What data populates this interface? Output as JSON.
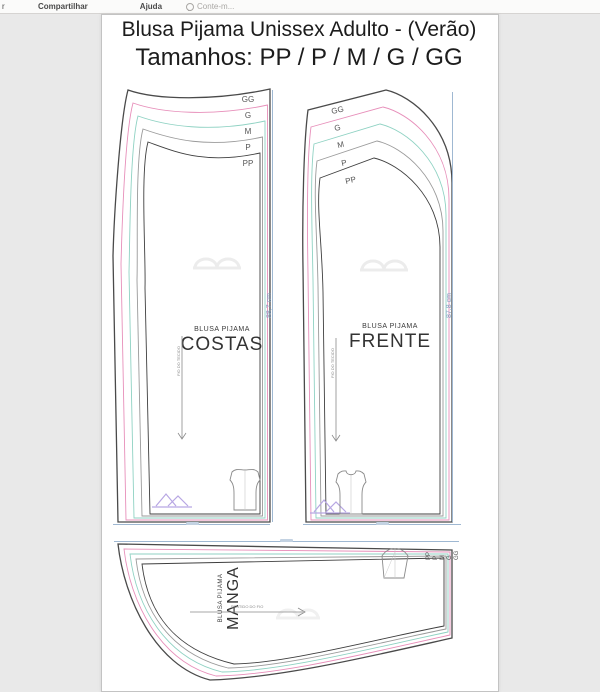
{
  "toolbar": {
    "fragment": "r",
    "share_label": "Compartilhar",
    "help_label": "Ajuda",
    "tellme_label": "Conte-m...",
    "tellme_icon": "lightbulb-icon"
  },
  "doc": {
    "title": "Blusa Pijama Unissex Adulto - (Verão)",
    "subtitle": "Tamanhos: PP / P / M / G / GG",
    "costas": {
      "brand": "BLUSA PIJAMA",
      "name": "COSTAS",
      "grain": "FIO DO TECIDO",
      "dim": "88,7 cm",
      "sizes": [
        "GG",
        "G",
        "M",
        "P",
        "PP"
      ]
    },
    "frente": {
      "brand": "BLUSA PIJAMA",
      "name": "FRENTE",
      "grain": "FIO DO TECIDO",
      "dim": "87,8 cm",
      "sizes": [
        "GG",
        "G",
        "M",
        "P",
        "PP"
      ]
    },
    "manga": {
      "brand": "BLUSA PIJAMA",
      "name": "MANGA",
      "grain": "SENTIDO DO FIO",
      "sizes": [
        "PP",
        "P",
        "M",
        "G",
        "GG"
      ]
    },
    "colors": {
      "size_gg": "#4a4a4a",
      "size_g": "#e78fba",
      "size_m": "#8fd2c3",
      "size_p": "#9a9a9a",
      "size_pp": "#3f3f3f",
      "dimension": "#9fb8d2",
      "logo": "#b7a6e3"
    }
  }
}
